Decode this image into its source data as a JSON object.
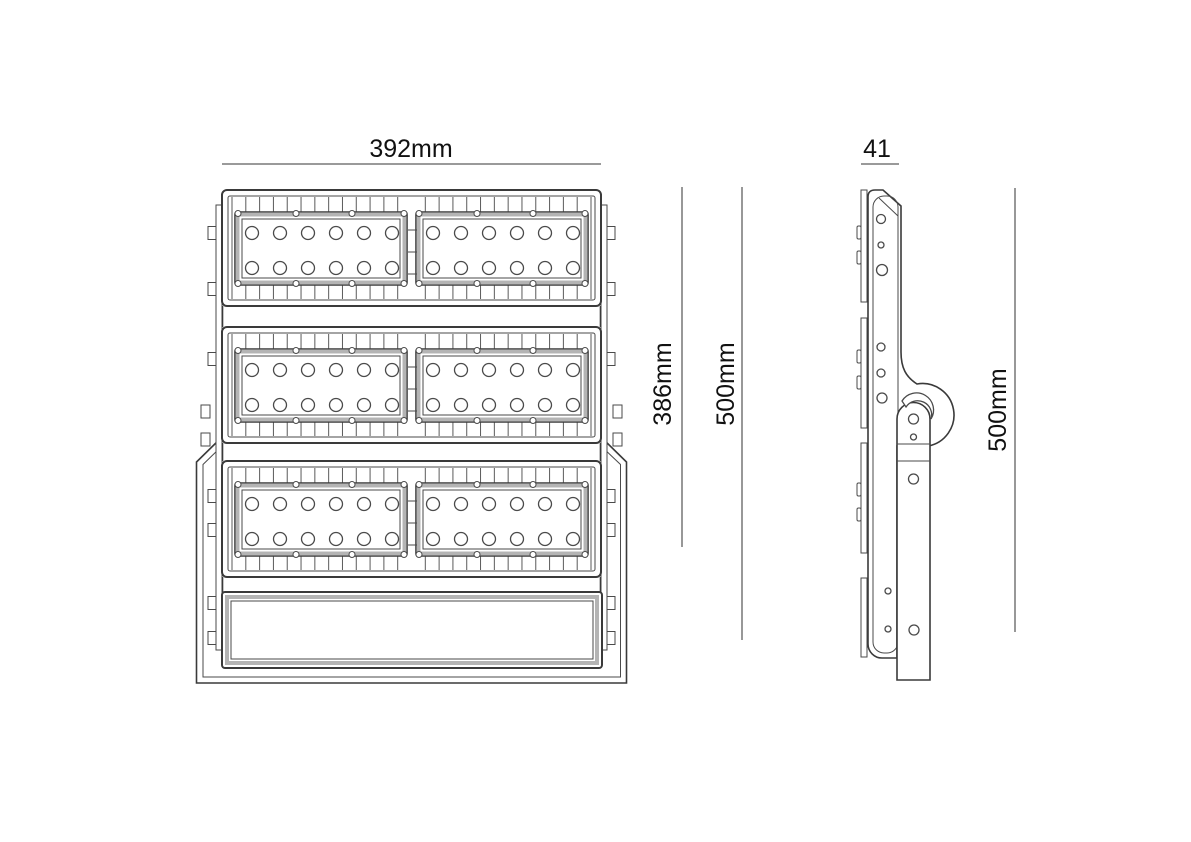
{
  "title": "LED floodlight dimensional drawing",
  "dimensions": {
    "front_width": "392mm",
    "front_module_height": "386mm",
    "front_total_height": "500mm",
    "side_depth": "41",
    "side_height": "500mm"
  },
  "fixture": {
    "module_rows": 3,
    "panels_per_row": 2,
    "led_columns_per_panel": 6,
    "led_rows_per_panel": 2,
    "leds_per_panel": 12,
    "total_leds": 72
  },
  "colors": {
    "outline": "#3a3a3a",
    "thin_line": "#4a4a4a",
    "accent_gray": "#b4b4b4",
    "dimension_line": "#8c8c8c",
    "label_text": "#111111",
    "background": "#ffffff"
  }
}
